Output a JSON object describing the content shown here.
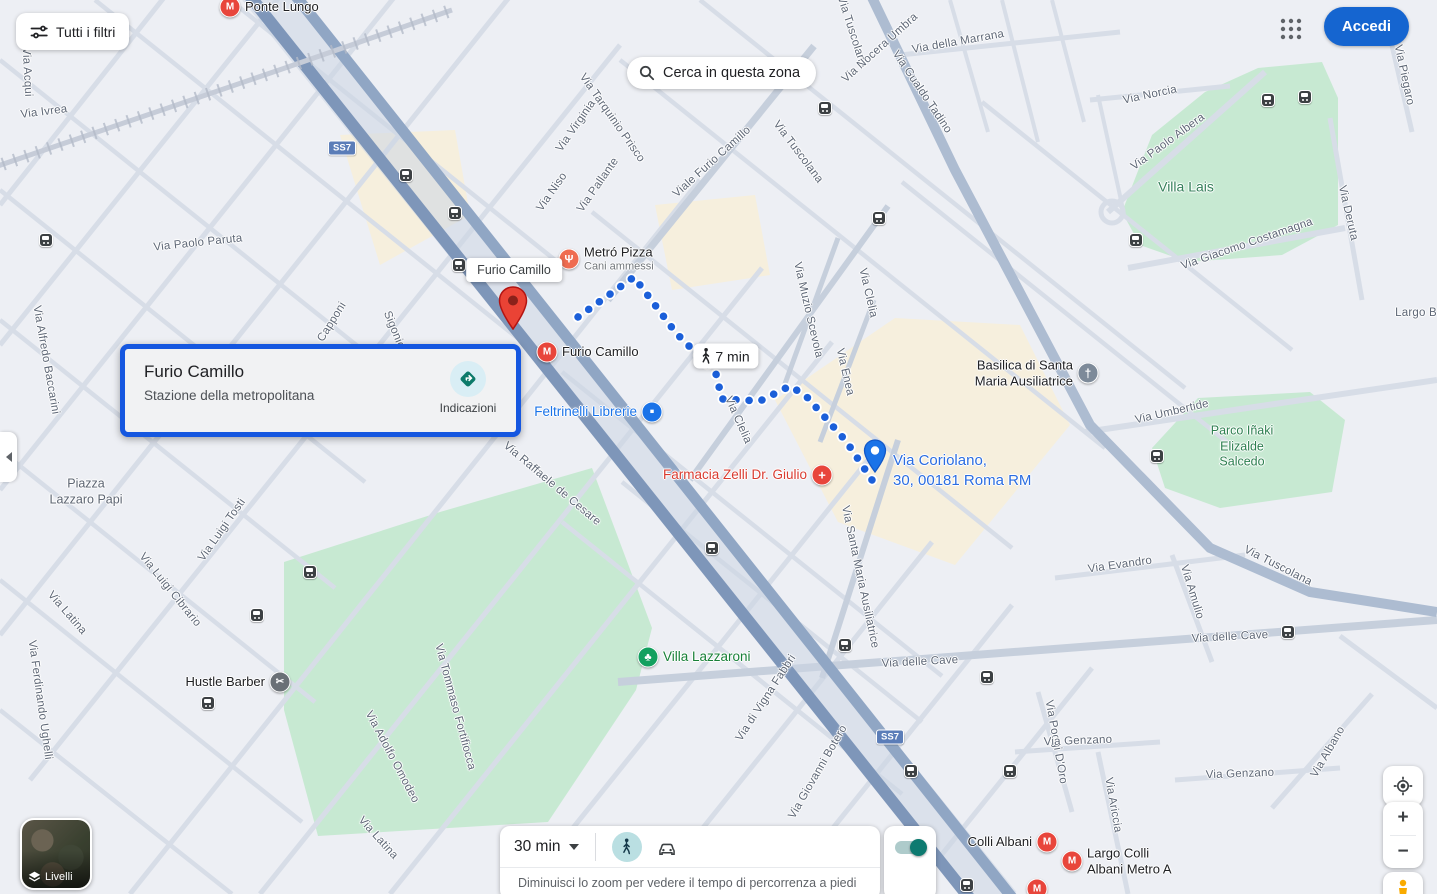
{
  "top_bar": {
    "filters_button": "Tutti i filtri",
    "search_button": "Cerca in questa zona",
    "signin_button": "Accedi"
  },
  "info_card": {
    "title": "Furio Camillo",
    "subtitle": "Stazione della metropolitana",
    "directions_label": "Indicazioni"
  },
  "route": {
    "origin_tooltip": "Furio Camillo",
    "duration_badge": "7 min",
    "destination_label": "Via Coriolano,\n30, 00181 Roma RM",
    "origin_pin": {
      "x": 513,
      "y": 335
    },
    "destination_pin": {
      "x": 875,
      "y": 478
    },
    "points": [
      [
        578,
        317
      ],
      [
        634,
        277
      ],
      [
        676,
        333
      ],
      [
        700,
        357
      ],
      [
        716,
        374
      ],
      [
        722,
        399
      ],
      [
        760,
        401
      ],
      [
        790,
        386
      ],
      [
        806,
        396
      ],
      [
        846,
        441
      ],
      [
        876,
        486
      ]
    ]
  },
  "bottom_panel": {
    "duration_selector": "30 min",
    "hint": "Diminuisci lo zoom per vedere il tempo di percorrenza a piedi"
  },
  "map_controls": {
    "layers_label": "Livelli",
    "zoom_in": "+",
    "zoom_out": "−"
  },
  "map": {
    "street_labels": [
      {
        "text": "Via Acqui",
        "x": 27,
        "y": 72,
        "r": 87
      },
      {
        "text": "Via Ivrea",
        "x": 44,
        "y": 112,
        "r": -7
      },
      {
        "text": "Via Paolo Paruta",
        "x": 198,
        "y": 243,
        "r": -6
      },
      {
        "text": "Via Alfredo Baccarini",
        "x": 46,
        "y": 360,
        "r": 80
      },
      {
        "text": "Capponi",
        "x": 332,
        "y": 322,
        "r": -58
      },
      {
        "text": "Sigonio",
        "x": 394,
        "y": 330,
        "r": 68
      },
      {
        "text": "Via Tarquinio Prisco",
        "x": 612,
        "y": 118,
        "r": 55
      },
      {
        "text": "Via Virginia",
        "x": 576,
        "y": 126,
        "r": -55
      },
      {
        "text": "Via Niso",
        "x": 552,
        "y": 192,
        "r": -55
      },
      {
        "text": "Via Pallante",
        "x": 598,
        "y": 185,
        "r": -55
      },
      {
        "text": "Viale Furio Camillo",
        "x": 712,
        "y": 162,
        "r": -42
      },
      {
        "text": "Via Tuscolana",
        "x": 798,
        "y": 152,
        "r": 53
      },
      {
        "text": "Via Tuscolana",
        "x": 852,
        "y": 32,
        "r": 72
      },
      {
        "text": "Via Nocera Umbra",
        "x": 880,
        "y": 48,
        "r": -42
      },
      {
        "text": "Via della Marrana",
        "x": 958,
        "y": 42,
        "r": -10
      },
      {
        "text": "Via Gualdo Tadino",
        "x": 922,
        "y": 92,
        "r": 56
      },
      {
        "text": "Via Norcia",
        "x": 1150,
        "y": 95,
        "r": -12
      },
      {
        "text": "Via Paolo Albera",
        "x": 1168,
        "y": 142,
        "r": -36
      },
      {
        "text": "Via Giacomo Costamagna",
        "x": 1247,
        "y": 244,
        "r": -19
      },
      {
        "text": "Via Deruta",
        "x": 1348,
        "y": 213,
        "r": 77
      },
      {
        "text": "Via Piegaro",
        "x": 1404,
        "y": 75,
        "r": 78
      },
      {
        "text": "Largo B",
        "x": 1416,
        "y": 313,
        "r": 0
      },
      {
        "text": "Via Umbertide",
        "x": 1172,
        "y": 412,
        "r": -13
      },
      {
        "text": "Via Muzio Scevola",
        "x": 808,
        "y": 310,
        "r": 77
      },
      {
        "text": "Via Clelia",
        "x": 868,
        "y": 293,
        "r": 77
      },
      {
        "text": "Via Clelia",
        "x": 738,
        "y": 420,
        "r": 66
      },
      {
        "text": "Via Enea",
        "x": 845,
        "y": 372,
        "r": 77
      },
      {
        "text": "Via Santa Maria Ausiliatrice",
        "x": 860,
        "y": 577,
        "r": 78
      },
      {
        "text": "Via Evandro",
        "x": 1120,
        "y": 565,
        "r": -8
      },
      {
        "text": "Via Amulio",
        "x": 1192,
        "y": 592,
        "r": 73
      },
      {
        "text": "Via Tuscolana",
        "x": 1278,
        "y": 566,
        "r": 27
      },
      {
        "text": "Via delle Cave",
        "x": 1230,
        "y": 637,
        "r": -3
      },
      {
        "text": "Via delle Cave",
        "x": 920,
        "y": 662,
        "r": -3
      },
      {
        "text": "Via Poggi D'Oro",
        "x": 1056,
        "y": 742,
        "r": 80
      },
      {
        "text": "Via Genzano",
        "x": 1078,
        "y": 741,
        "r": -2
      },
      {
        "text": "Via Genzano",
        "x": 1240,
        "y": 774,
        "r": -2
      },
      {
        "text": "Via Albano",
        "x": 1328,
        "y": 752,
        "r": -60
      },
      {
        "text": "Via Ariccia",
        "x": 1113,
        "y": 805,
        "r": 80
      },
      {
        "text": "Via Luigi Tosti",
        "x": 222,
        "y": 530,
        "r": -55
      },
      {
        "text": "Via Luigi Cibrario",
        "x": 170,
        "y": 590,
        "r": 51
      },
      {
        "text": "Via Latina",
        "x": 67,
        "y": 613,
        "r": 49
      },
      {
        "text": "Via Latina",
        "x": 378,
        "y": 838,
        "r": 48
      },
      {
        "text": "Via Ferdinando Ughelli",
        "x": 40,
        "y": 700,
        "r": 82
      },
      {
        "text": "Via Raffaele de Cesare",
        "x": 552,
        "y": 484,
        "r": 40
      },
      {
        "text": "Via Tommaso Fortifiocca",
        "x": 455,
        "y": 707,
        "r": 75
      },
      {
        "text": "Via Adolfo Omodeo",
        "x": 392,
        "y": 757,
        "r": 62
      },
      {
        "text": "Via di Vigna Fabbri",
        "x": 766,
        "y": 698,
        "r": -57
      },
      {
        "text": "Via Giovanni Botero",
        "x": 818,
        "y": 772,
        "r": -60
      }
    ],
    "area_labels": [
      {
        "text": "Villa Lais",
        "x": 1186,
        "y": 187,
        "cls": "park-big"
      },
      {
        "text": "Parco Iñaki\nElizalde\nSalcedo",
        "x": 1242,
        "y": 447,
        "cls": "park"
      },
      {
        "text": "Piazza\nLazzaro Papi",
        "x": 86,
        "y": 492,
        "cls": "locality"
      }
    ],
    "poi_labels": [
      {
        "icon": "metro-icon",
        "text": "Ponte Lungo",
        "x": 230,
        "y": 7,
        "side": "left",
        "cls": ""
      },
      {
        "icon": "restaurant-icon",
        "text": "Metró Pizza",
        "sub": "Cani ammessi",
        "x": 569,
        "y": 259,
        "side": "left",
        "cls": ""
      },
      {
        "icon": "metro-icon",
        "text": "Furio Camillo",
        "x": 547,
        "y": 352,
        "side": "left",
        "cls": ""
      },
      {
        "icon": "shop-icon",
        "text": "Feltrinelli Librerie",
        "x": 652,
        "y": 412,
        "side": "right",
        "cls": "blue"
      },
      {
        "icon": "pharmacy-icon",
        "text": "Farmacia Zelli Dr. Giulio",
        "x": 822,
        "y": 475,
        "side": "right",
        "cls": "red"
      },
      {
        "icon": "church-icon",
        "text": "Basilica di Santa\nMaria Ausiliatrice",
        "x": 1088,
        "y": 373,
        "side": "right",
        "cls": ""
      },
      {
        "icon": "tree-icon",
        "text": "Villa Lazzaroni",
        "x": 648,
        "y": 657,
        "side": "left",
        "cls": "green"
      },
      {
        "icon": "barber-icon",
        "text": "Hustle Barber",
        "x": 280,
        "y": 682,
        "side": "right",
        "cls": ""
      },
      {
        "icon": "metro-icon",
        "text": "Colli Albani",
        "x": 1047,
        "y": 842,
        "side": "right",
        "cls": ""
      },
      {
        "icon": "metro-icon",
        "text": "Largo Colli\nAlbani Metro A",
        "x": 1072,
        "y": 861,
        "side": "left",
        "cls": ""
      },
      {
        "icon": "metro-icon",
        "text": "",
        "x": 1037,
        "y": 889,
        "side": "left",
        "cls": ""
      }
    ],
    "bus_stops": [
      [
        46,
        240
      ],
      [
        406,
        175
      ],
      [
        455,
        213
      ],
      [
        459,
        265
      ],
      [
        825,
        108
      ],
      [
        879,
        218
      ],
      [
        1268,
        100
      ],
      [
        1305,
        97
      ],
      [
        1136,
        240
      ],
      [
        1157,
        456
      ],
      [
        712,
        548
      ],
      [
        845,
        645
      ],
      [
        987,
        677
      ],
      [
        911,
        771
      ],
      [
        1010,
        771
      ],
      [
        1288,
        632
      ],
      [
        310,
        572
      ],
      [
        257,
        615
      ],
      [
        208,
        703
      ],
      [
        967,
        885
      ]
    ],
    "route_shields": [
      {
        "text": "SS7",
        "x": 342,
        "y": 148
      },
      {
        "text": "SS7",
        "x": 890,
        "y": 737
      }
    ]
  },
  "colors": {
    "signin_blue": "#1565d0",
    "selection_border": "#1557e0",
    "route_blue": "#1b5fd9",
    "link_blue": "#1a73e8",
    "poi_red": "#e8453b",
    "park_green": "#c7e9d2",
    "major_road": "#7e96b9"
  }
}
